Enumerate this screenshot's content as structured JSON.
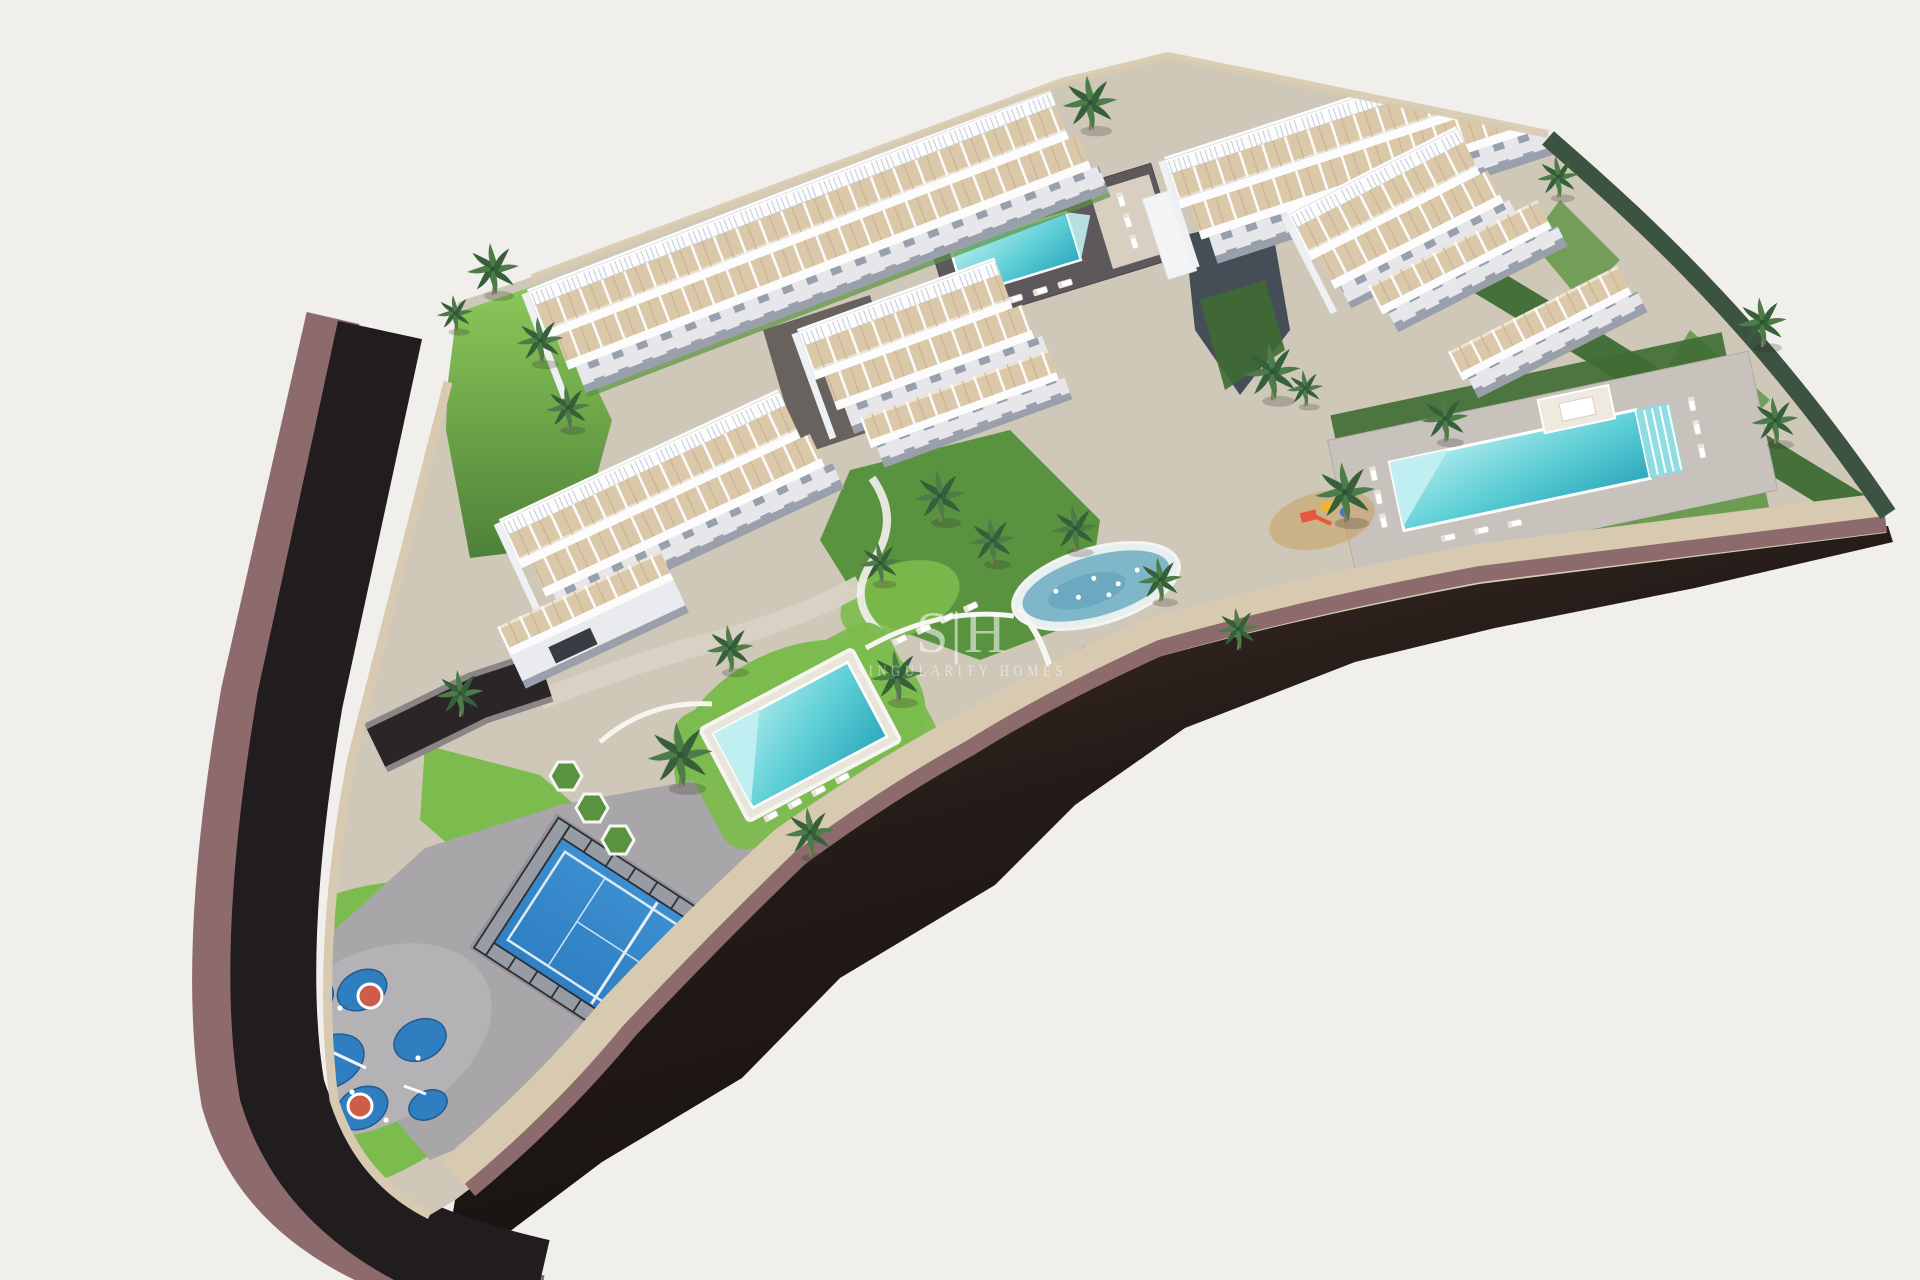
{
  "watermark": {
    "logo": "S|H",
    "name": "SINGULARITY HOMES"
  },
  "colors": {
    "bg": "#f1efec",
    "road": "#211c1e",
    "roadBrown": "#4a372c",
    "roadDeep": "#110e0f",
    "sidewalk": "#8d6b6c",
    "wallStone": "#d7cab0",
    "pavingLight": "#cfc8b9",
    "pavingGray": "#a9a6aa",
    "pavingPale": "#b5b2b6",
    "terrace": "#dac8a9",
    "facade": "#e7e6ea",
    "white": "#fcfcfd",
    "shadow": "#9aa0ab",
    "grass": "#7cbb4d",
    "grassMid": "#5a9340",
    "grassDark": "#3e6b33",
    "hedge": "#3c5342",
    "poolLight": "#b9eef0",
    "poolMid": "#5ecfd6",
    "poolDeep": "#2fa9bd",
    "court": "#2f7fc2",
    "courtDark": "#24679f",
    "playBlue": "#2e7ec0",
    "playRed": "#cd5c49",
    "palm": "#4d7c48",
    "palmDark": "#35603a",
    "trunk": "#8a7a60",
    "pond": "#7fb7c9",
    "gravel": "#55504e",
    "darkWall": "#454e57",
    "watermark": "#ffffff"
  }
}
